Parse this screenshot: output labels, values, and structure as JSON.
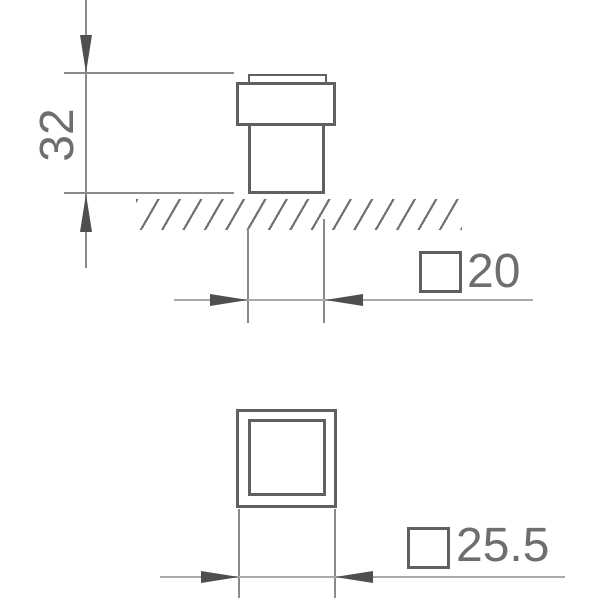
{
  "drawing": {
    "dim_height": {
      "value": "32",
      "orientation": "vertical"
    },
    "dim_width_top": {
      "symbol": "square-section",
      "value": "20"
    },
    "dim_width_base": {
      "symbol": "square-section",
      "value": "25.5"
    }
  },
  "colors": {
    "background": "#ffffff",
    "outline": "#606060",
    "line_med": "#8a8a8a",
    "line_light": "#a9a9a9",
    "arrow": "#4f4f4f",
    "text": "#6e6e6e",
    "hatch": "#707070"
  }
}
